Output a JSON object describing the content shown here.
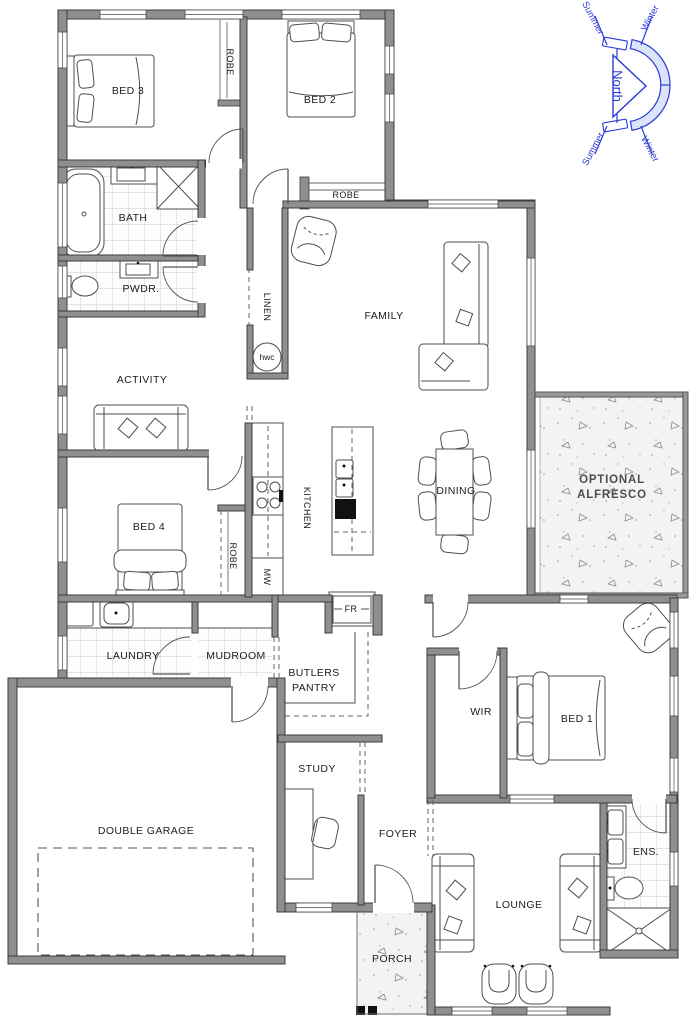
{
  "rooms": {
    "bed3": "BED 3",
    "robe_bed3": "ROBE",
    "bed2": "BED 2",
    "robe_bed2": "ROBE",
    "bath": "BATH",
    "pwdr": "PWDR.",
    "linen": "LINEN",
    "hwc": "hwc",
    "family": "FAMILY",
    "activity": "ACTIVITY",
    "kitchen": "KITCHEN",
    "dining": "DINING",
    "alfresco_line1": "OPTIONAL",
    "alfresco_line2": "ALFRESCO",
    "bed4": "BED 4",
    "robe_bed4": "ROBE",
    "mw": "MW",
    "fr": "FR",
    "laundry": "LAUNDRY",
    "mudroom": "MUDROOM",
    "butlers_line1": "BUTLERS",
    "butlers_line2": "PANTRY",
    "wir": "WIR",
    "bed1": "BED 1",
    "garage": "DOUBLE GARAGE",
    "study": "STUDY",
    "foyer": "FOYER",
    "ens": "ENS.",
    "lounge": "LOUNGE",
    "porch": "PORCH"
  },
  "compass": {
    "north": "North",
    "summer": "Summer",
    "winter": "Winter"
  },
  "colors": {
    "wall": "#8f8f8f",
    "wall_edge": "#3c3c3c",
    "compass_blue": "#2b3bd6",
    "compass_fill": "#dce5f7",
    "tile_line": "#b9b9b9",
    "concrete_bg": "#f4f3f1"
  }
}
